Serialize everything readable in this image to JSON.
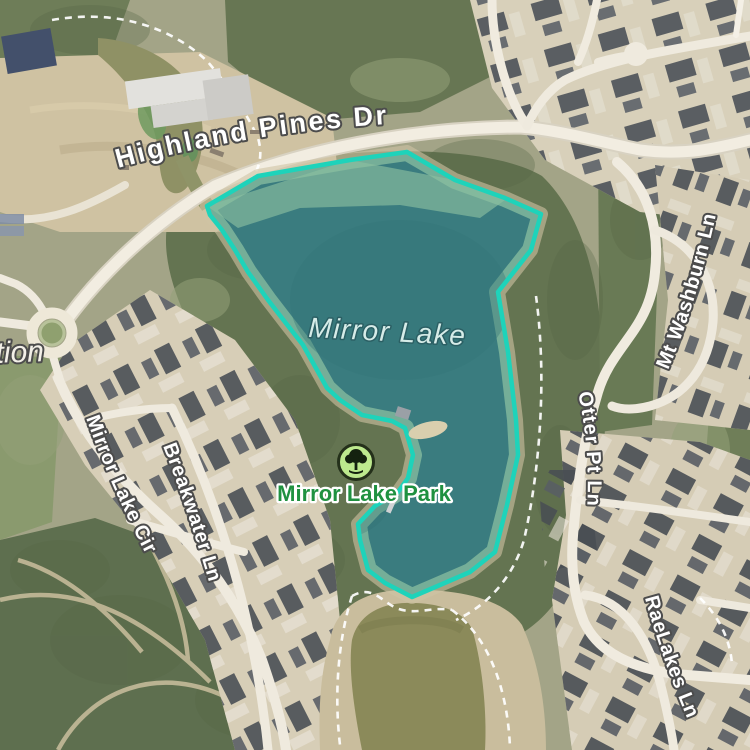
{
  "map": {
    "labels": {
      "highland_pines": "Highland Pines Dr",
      "mirror_lake": "Mirror Lake",
      "mirror_lake_park": "Mirror Lake Park",
      "mirror_lake_cir": "Mirror Lake Cir",
      "breakwater_ln": "Breakwater Ln",
      "otter_pt_ln": "Otter Pt Ln",
      "mt_washburn_ln": "Mt Washburn Ln",
      "rae_lakes_ln": "RaeLakes Ln",
      "partial_area_left": "tion"
    },
    "poi": {
      "park_marker_icon": "tree-icon"
    },
    "colors": {
      "lake_fill": "#3a7c7f",
      "lake_shallow": "#8abfa0",
      "lake_outline": "#1ed3ba",
      "pond_fill": "#8b8a5a",
      "road_fill": "#f2ede1",
      "park_label_green": "#1f9140",
      "park_icon_bg": "#bde98e",
      "label_white": "#ffffff"
    }
  }
}
